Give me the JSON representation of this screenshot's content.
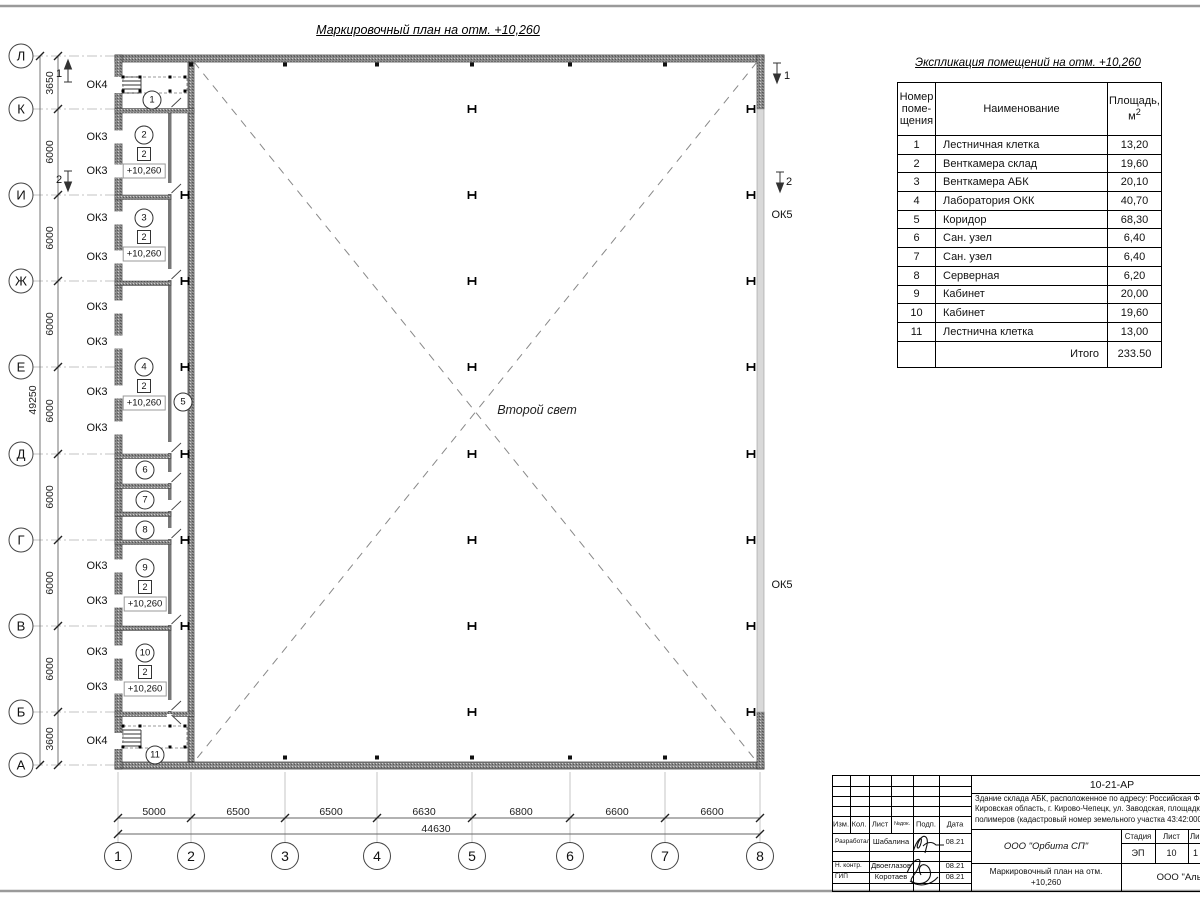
{
  "sheet": {
    "plan_title": "Маркировочный план на отм. +10,260",
    "second_light": "Второй свет"
  },
  "plan": {
    "axis_rows": [
      {
        "t": "Л",
        "x": 21,
        "y": 56
      },
      {
        "t": "К",
        "x": 21,
        "y": 109
      },
      {
        "t": "И",
        "x": 21,
        "y": 195
      },
      {
        "t": "Ж",
        "x": 21,
        "y": 281
      },
      {
        "t": "Е",
        "x": 21,
        "y": 367
      },
      {
        "t": "Д",
        "x": 21,
        "y": 454
      },
      {
        "t": "Г",
        "x": 21,
        "y": 540
      },
      {
        "t": "В",
        "x": 21,
        "y": 626
      },
      {
        "t": "Б",
        "x": 21,
        "y": 712
      },
      {
        "t": "А",
        "x": 21,
        "y": 765
      }
    ],
    "axis_cols": [
      {
        "t": "1",
        "x": 118,
        "y": 856
      },
      {
        "t": "2",
        "x": 191,
        "y": 856
      },
      {
        "t": "3",
        "x": 285,
        "y": 856
      },
      {
        "t": "4",
        "x": 377,
        "y": 856
      },
      {
        "t": "5",
        "x": 472,
        "y": 856
      },
      {
        "t": "6",
        "x": 570,
        "y": 856
      },
      {
        "t": "7",
        "x": 665,
        "y": 856
      },
      {
        "t": "8",
        "x": 760,
        "y": 856
      }
    ],
    "dim_rows": [
      {
        "t": "3650",
        "x": 50,
        "y": 83
      },
      {
        "t": "6000",
        "x": 50,
        "y": 152
      },
      {
        "t": "6000",
        "x": 50,
        "y": 238
      },
      {
        "t": "6000",
        "x": 50,
        "y": 324
      },
      {
        "t": "6000",
        "x": 50,
        "y": 411
      },
      {
        "t": "6000",
        "x": 50,
        "y": 497
      },
      {
        "t": "6000",
        "x": 50,
        "y": 583
      },
      {
        "t": "6000",
        "x": 50,
        "y": 669
      },
      {
        "t": "3600",
        "x": 50,
        "y": 739
      }
    ],
    "dim_rows_total": {
      "t": "49250",
      "x": 33,
      "y": 400
    },
    "dim_cols": [
      {
        "t": "5000",
        "x": 154,
        "y": 812
      },
      {
        "t": "6500",
        "x": 238,
        "y": 812
      },
      {
        "t": "6500",
        "x": 331,
        "y": 812
      },
      {
        "t": "6630",
        "x": 424,
        "y": 812
      },
      {
        "t": "6800",
        "x": 521,
        "y": 812
      },
      {
        "t": "6600",
        "x": 617,
        "y": 812
      },
      {
        "t": "6600",
        "x": 712,
        "y": 812
      }
    ],
    "dim_cols_total": {
      "t": "44630",
      "x": 436,
      "y": 829
    },
    "window_labels": [
      {
        "t": "ОК4",
        "x": 97,
        "y": 85
      },
      {
        "t": "ОК3",
        "x": 97,
        "y": 137
      },
      {
        "t": "ОК3",
        "x": 97,
        "y": 171
      },
      {
        "t": "ОК3",
        "x": 97,
        "y": 218
      },
      {
        "t": "ОК3",
        "x": 97,
        "y": 257
      },
      {
        "t": "ОК3",
        "x": 97,
        "y": 307
      },
      {
        "t": "ОК3",
        "x": 97,
        "y": 342
      },
      {
        "t": "ОК3",
        "x": 97,
        "y": 392
      },
      {
        "t": "ОК3",
        "x": 97,
        "y": 428
      },
      {
        "t": "ОК3",
        "x": 97,
        "y": 566
      },
      {
        "t": "ОК3",
        "x": 97,
        "y": 601
      },
      {
        "t": "ОК3",
        "x": 97,
        "y": 652
      },
      {
        "t": "ОК3",
        "x": 97,
        "y": 687
      },
      {
        "t": "ОК4",
        "x": 97,
        "y": 741
      }
    ],
    "ok5_labels": [
      {
        "t": "ОК5",
        "x": 782,
        "y": 215
      },
      {
        "t": "ОК5",
        "x": 782,
        "y": 585
      }
    ],
    "section_markers": [
      {
        "t": "1",
        "x": 59,
        "y": 74
      },
      {
        "t": "2",
        "x": 59,
        "y": 180
      },
      {
        "t": "1",
        "x": 787,
        "y": 76
      },
      {
        "t": "2",
        "x": 789,
        "y": 182
      }
    ],
    "rooms": [
      {
        "num": "1",
        "x": 152,
        "y": 100
      },
      {
        "num": "2",
        "x": 144,
        "y": 135,
        "badge": "2",
        "elev": "+10,260"
      },
      {
        "num": "3",
        "x": 144,
        "y": 218,
        "badge": "2",
        "elev": "+10,260"
      },
      {
        "num": "4",
        "x": 144,
        "y": 367,
        "badge": "2",
        "elev": "+10,260"
      },
      {
        "num": "5",
        "x": 183,
        "y": 402
      },
      {
        "num": "6",
        "x": 145,
        "y": 470
      },
      {
        "num": "7",
        "x": 145,
        "y": 500
      },
      {
        "num": "8",
        "x": 145,
        "y": 530
      },
      {
        "num": "9",
        "x": 145,
        "y": 568,
        "badge": "2",
        "elev": "+10,260"
      },
      {
        "num": "10",
        "x": 145,
        "y": 653,
        "badge": "2",
        "elev": "+10,260"
      },
      {
        "num": "11",
        "x": 155,
        "y": 755
      }
    ]
  },
  "explication": {
    "title": "Экспликация помещений на отм. +10,260",
    "header": {
      "num_lines": [
        "Номер",
        "поме-",
        "щения"
      ],
      "name": "Наименование",
      "area_line1": "Площадь,",
      "area_base": "м",
      "area_sup": "2"
    },
    "rows": [
      {
        "num": "1",
        "name": "Лестничная клетка",
        "area": "13,20"
      },
      {
        "num": "2",
        "name": "Венткамера склад",
        "area": "19,60"
      },
      {
        "num": "3",
        "name": "Венткамера АБК",
        "area": "20,10"
      },
      {
        "num": "4",
        "name": "Лаборатория ОКК",
        "area": "40,70"
      },
      {
        "num": "5",
        "name": "Коридор",
        "area": "68,30"
      },
      {
        "num": "6",
        "name": "Сан. узел",
        "area": "6,40"
      },
      {
        "num": "7",
        "name": "Сан. узел",
        "area": "6,40"
      },
      {
        "num": "8",
        "name": "Серверная",
        "area": "6,20"
      },
      {
        "num": "9",
        "name": "Кабинет",
        "area": "20,00"
      },
      {
        "num": "10",
        "name": "Кабинет",
        "area": "19,60"
      },
      {
        "num": "11",
        "name": "Лестнична клетка",
        "area": "13,00"
      }
    ],
    "total_label": "Итого",
    "total_value": "233.50"
  },
  "titleblock": {
    "doc_number": "10-21-АР",
    "description_lines": [
      "Здание склада АБК, расположенное по адресу: Российская Феде",
      "Кировская область, г. Кирово-Чепецк, ул. Заводская, площадка з",
      "полимеров (кадастровый номер земельного участка 43:42:0000"
    ],
    "header_cells": [
      {
        "t": "Изм.",
        "x": 8,
        "y": 48
      },
      {
        "t": "Кол.",
        "x": 26,
        "y": 48
      },
      {
        "t": "Лист",
        "x": 47,
        "y": 48
      },
      {
        "t": "№док.",
        "x": 69,
        "y": 48,
        "fs": 5.5
      },
      {
        "t": "Подп.",
        "x": 93,
        "y": 48
      },
      {
        "t": "Дата",
        "x": 122,
        "y": 48
      }
    ],
    "sig_rows": [
      {
        "role": "Разработал",
        "name": "Шабалина",
        "date": "08.21",
        "y": 66
      },
      {
        "role": "Н. контр.",
        "name": "Двоеглазов",
        "date": "08.21",
        "y": 90
      },
      {
        "role": "ГИП",
        "name": "Коротаев",
        "date": "08.21",
        "y": 101
      }
    ],
    "org1": "ООО \"Орбита СП\"",
    "stage_label": "Стадия",
    "sheet_label": "Лист",
    "sheets_label": "Ли",
    "stage_value": "ЭП",
    "sheet_value": "10",
    "sheets_value": "1",
    "subtitle_line1": "Маркировочный план на отм.",
    "subtitle_line2": "+10,260",
    "org2": "ООО \"Альяно"
  },
  "colors": {
    "wall_dark": "#6b6b6b",
    "window_band": "#d9d9d9",
    "line": "#000000",
    "frame": "#9a9a9a"
  }
}
